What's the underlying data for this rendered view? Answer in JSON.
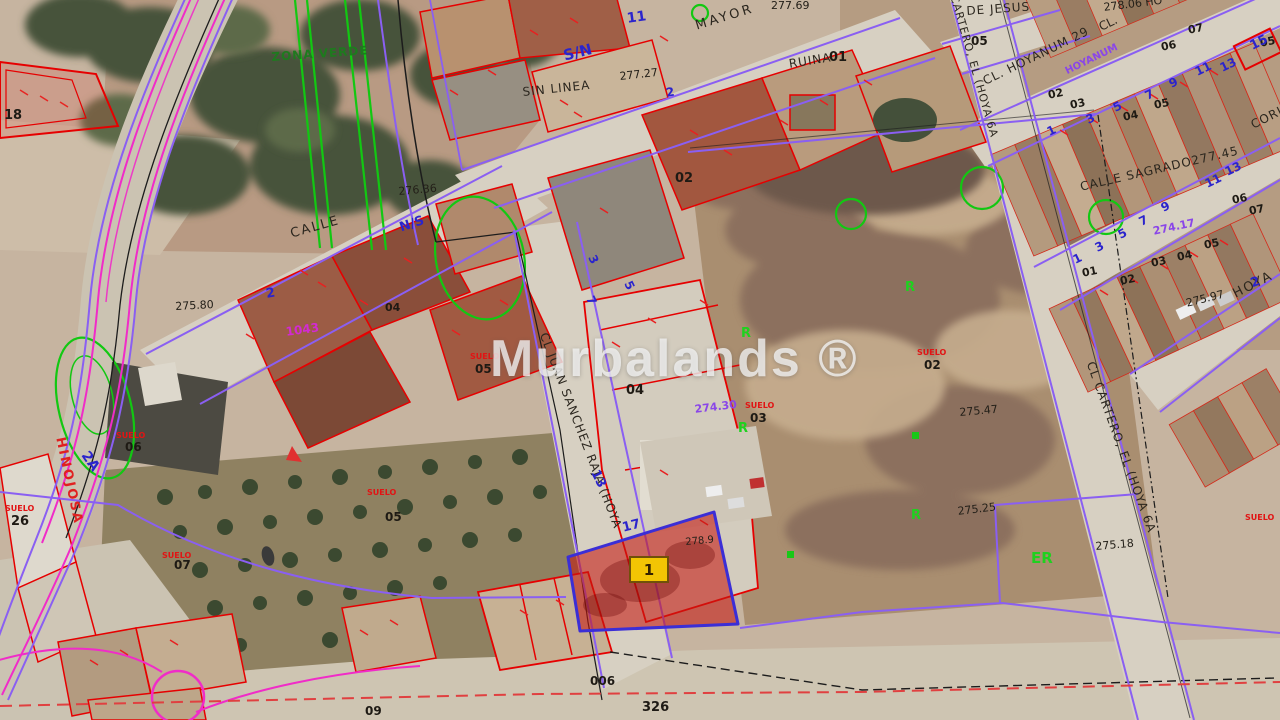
{
  "watermark": {
    "text": "Murbalands ®"
  },
  "parcel_badge": {
    "label": "1"
  },
  "annotations": [
    {
      "id": "mayor",
      "text": "MAYOR",
      "c": "st",
      "x": 694,
      "y": 20,
      "r": -17,
      "s": 13,
      "ls": 3
    },
    {
      "id": "sin-linea",
      "text": "SIN LINEA",
      "c": "st",
      "x": 522,
      "y": 86,
      "r": -6,
      "s": 12,
      "ls": 1
    },
    {
      "id": "calle-west",
      "text": "CALLE",
      "c": "st",
      "x": 289,
      "y": 228,
      "r": -16,
      "s": 13,
      "ls": 2
    },
    {
      "id": "calle-sagrado",
      "text": "CALLE SAGRADO277.45",
      "c": "st",
      "x": 1079,
      "y": 181,
      "r": -13,
      "s": 12,
      "ls": 1
    },
    {
      "id": "hoya",
      "text": "HOYA",
      "c": "st",
      "x": 1231,
      "y": 289,
      "r": -27,
      "s": 13,
      "ls": 2
    },
    {
      "id": "de-jesus",
      "text": "DE JESUS",
      "c": "st",
      "x": 966,
      "y": 5,
      "r": -4,
      "s": 12,
      "ls": 1
    },
    {
      "id": "cl-hoyanum",
      "text": "CL. HOYANUM 29",
      "c": "st",
      "x": 981,
      "y": 76,
      "r": -26,
      "s": 12,
      "ls": 1
    },
    {
      "id": "cl-abbrev",
      "text": "CL.",
      "c": "st",
      "x": 1097,
      "y": 22,
      "r": -26,
      "s": 12
    },
    {
      "id": "juan-sanchez",
      "text": "CL JUAN SANCHEZ RAJA (HOYA",
      "c": "st",
      "x": 549,
      "y": 331,
      "r": 69,
      "s": 12,
      "ls": 1
    },
    {
      "id": "cartero",
      "text": "CL CARTERO, EL (HOYA 6A",
      "c": "st",
      "x": 1096,
      "y": 360,
      "r": 70,
      "s": 12,
      "ls": 1
    },
    {
      "id": "cartero-top",
      "text": "CARTERO, EL (HOYA 6A",
      "c": "st",
      "x": 959,
      "y": -6,
      "r": 74,
      "s": 11,
      "ls": 1
    },
    {
      "id": "cori",
      "text": "CORI",
      "c": "st",
      "x": 1249,
      "y": 120,
      "r": -27,
      "s": 12,
      "ls": 1
    },
    {
      "id": "ruina",
      "text": "RUINA",
      "c": "st",
      "x": 788,
      "y": 58,
      "r": -9,
      "s": 12,
      "ls": 1
    },
    {
      "id": "hinojosa",
      "text": "HINOJOSA",
      "c": "rst",
      "x": 66,
      "y": 436,
      "r": 78,
      "s": 13,
      "ls": 2
    },
    {
      "id": "zona-verde",
      "text": "ZONA VERDE",
      "c": "gst",
      "x": 271,
      "y": 51,
      "r": -4,
      "s": 12,
      "ls": 1
    },
    {
      "id": "e27769",
      "text": "277.69",
      "c": "el",
      "x": 771,
      "y": 0,
      "r": 0,
      "s": 11
    },
    {
      "id": "e27727",
      "text": "277.27",
      "c": "el",
      "x": 619,
      "y": 71,
      "r": -6,
      "s": 11
    },
    {
      "id": "e27636",
      "text": "276.36",
      "c": "el",
      "x": 398,
      "y": 186,
      "r": -5,
      "s": 11
    },
    {
      "id": "e27580",
      "text": "275.80",
      "c": "el",
      "x": 175,
      "y": 301,
      "r": -3,
      "s": 11
    },
    {
      "id": "e27547",
      "text": "275.47",
      "c": "el",
      "x": 959,
      "y": 407,
      "r": -5,
      "s": 11
    },
    {
      "id": "e27525",
      "text": "275.25",
      "c": "el",
      "x": 957,
      "y": 506,
      "r": -7,
      "s": 11
    },
    {
      "id": "e27518",
      "text": "275.18",
      "c": "el",
      "x": 1095,
      "y": 541,
      "r": -5,
      "s": 11
    },
    {
      "id": "e27597",
      "text": "275.97",
      "c": "el",
      "x": 1185,
      "y": 298,
      "r": -14,
      "s": 11
    },
    {
      "id": "e2789",
      "text": "278.9",
      "c": "el",
      "x": 685,
      "y": 538,
      "r": -5,
      "s": 10
    },
    {
      "id": "e27806",
      "text": "278.06 HO",
      "c": "el",
      "x": 1103,
      "y": 2,
      "r": -7,
      "s": 11
    },
    {
      "id": "p27430",
      "text": "274.30",
      "c": "pu",
      "x": 694,
      "y": 404,
      "r": -7,
      "s": 11
    },
    {
      "id": "p27417",
      "text": "274.17",
      "c": "pu",
      "x": 1152,
      "y": 226,
      "r": -12,
      "s": 11
    },
    {
      "id": "p-hoyanum",
      "text": "HOYANUM",
      "c": "pu",
      "x": 1064,
      "y": 68,
      "r": -26,
      "s": 10
    },
    {
      "id": "n18",
      "text": "18",
      "c": "nu",
      "x": 4,
      "y": 109,
      "r": 0,
      "s": 13
    },
    {
      "id": "n26",
      "text": "26",
      "c": "nu",
      "x": 11,
      "y": 515,
      "r": 0,
      "s": 13
    },
    {
      "id": "n01",
      "text": "01",
      "c": "nu",
      "x": 829,
      "y": 51,
      "r": 0,
      "s": 13
    },
    {
      "id": "n02",
      "text": "02",
      "c": "nu",
      "x": 675,
      "y": 172,
      "r": 0,
      "s": 13
    },
    {
      "id": "n04a",
      "text": "04",
      "c": "nu",
      "x": 385,
      "y": 302,
      "r": 0,
      "s": 11
    },
    {
      "id": "n04b",
      "text": "04",
      "c": "nu",
      "x": 626,
      "y": 384,
      "r": 0,
      "s": 13
    },
    {
      "id": "n05a",
      "text": "05",
      "c": "nu",
      "x": 971,
      "y": 35,
      "r": 0,
      "s": 12
    },
    {
      "id": "n06a",
      "text": "06",
      "c": "nu",
      "x": 125,
      "y": 441,
      "r": 0,
      "s": 12
    },
    {
      "id": "n05b",
      "text": "05",
      "c": "nu",
      "x": 475,
      "y": 363,
      "r": 0,
      "s": 12
    },
    {
      "id": "n05c",
      "text": "05",
      "c": "nu",
      "x": 385,
      "y": 511,
      "r": 0,
      "s": 12
    },
    {
      "id": "n07a",
      "text": "07",
      "c": "nu",
      "x": 174,
      "y": 559,
      "r": 0,
      "s": 12
    },
    {
      "id": "n03a",
      "text": "03",
      "c": "nu",
      "x": 750,
      "y": 412,
      "r": 0,
      "s": 12
    },
    {
      "id": "n02b",
      "text": "02",
      "c": "nu",
      "x": 924,
      "y": 359,
      "r": 0,
      "s": 12
    },
    {
      "id": "n006",
      "text": "006",
      "c": "nu",
      "x": 590,
      "y": 675,
      "r": 0,
      "s": 12
    },
    {
      "id": "n326",
      "text": "326",
      "c": "nu",
      "x": 642,
      "y": 701,
      "r": 0,
      "s": 13
    },
    {
      "id": "n09",
      "text": "09",
      "c": "nu",
      "x": 365,
      "y": 705,
      "r": 0,
      "s": 12
    },
    {
      "id": "ra02",
      "text": "02",
      "c": "nu",
      "x": 1047,
      "y": 90,
      "r": -12,
      "s": 11
    },
    {
      "id": "ra03",
      "text": "03",
      "c": "nu",
      "x": 1069,
      "y": 100,
      "r": -12,
      "s": 11
    },
    {
      "id": "ra04",
      "text": "04",
      "c": "nu",
      "x": 1122,
      "y": 112,
      "r": -12,
      "s": 11
    },
    {
      "id": "ra05",
      "text": "05",
      "c": "nu",
      "x": 1153,
      "y": 100,
      "r": -12,
      "s": 11
    },
    {
      "id": "ra06",
      "text": "06",
      "c": "nu",
      "x": 1160,
      "y": 42,
      "r": -12,
      "s": 11
    },
    {
      "id": "ra07",
      "text": "07",
      "c": "nu",
      "x": 1187,
      "y": 25,
      "r": -12,
      "s": 11
    },
    {
      "id": "ra05b",
      "text": "05",
      "c": "nu",
      "x": 1259,
      "y": 38,
      "r": -12,
      "s": 11
    },
    {
      "id": "rb01",
      "text": "01",
      "c": "nu",
      "x": 1081,
      "y": 268,
      "r": -12,
      "s": 11
    },
    {
      "id": "rb02",
      "text": "02",
      "c": "nu",
      "x": 1119,
      "y": 276,
      "r": -12,
      "s": 11
    },
    {
      "id": "rb03",
      "text": "03",
      "c": "nu",
      "x": 1150,
      "y": 258,
      "r": -12,
      "s": 11
    },
    {
      "id": "rb04",
      "text": "04",
      "c": "nu",
      "x": 1176,
      "y": 252,
      "r": -12,
      "s": 11
    },
    {
      "id": "rb05",
      "text": "05",
      "c": "nu",
      "x": 1203,
      "y": 240,
      "r": -12,
      "s": 11
    },
    {
      "id": "rb06",
      "text": "06",
      "c": "nu",
      "x": 1231,
      "y": 195,
      "r": -12,
      "s": 11
    },
    {
      "id": "rb07",
      "text": "07",
      "c": "nu",
      "x": 1248,
      "y": 206,
      "r": -12,
      "s": 11
    },
    {
      "id": "b11",
      "text": "11",
      "c": "bl",
      "x": 626,
      "y": 12,
      "r": -8,
      "s": 14
    },
    {
      "id": "bsn",
      "text": "S/N",
      "c": "bl",
      "x": 562,
      "y": 49,
      "r": -14,
      "s": 15
    },
    {
      "id": "b2a",
      "text": "2",
      "c": "bl",
      "x": 665,
      "y": 87,
      "r": -10,
      "s": 12
    },
    {
      "id": "bns",
      "text": "N/S",
      "c": "bl",
      "x": 398,
      "y": 222,
      "r": -18,
      "s": 13
    },
    {
      "id": "b2b",
      "text": "2",
      "c": "bl",
      "x": 265,
      "y": 288,
      "r": -10,
      "s": 13
    },
    {
      "id": "b2A",
      "text": "2A",
      "c": "bl",
      "x": 90,
      "y": 449,
      "r": 55,
      "s": 14
    },
    {
      "id": "b3",
      "text": "3",
      "c": "bl",
      "x": 597,
      "y": 253,
      "r": 64,
      "s": 12
    },
    {
      "id": "b5",
      "text": "5",
      "c": "bl",
      "x": 633,
      "y": 279,
      "r": 64,
      "s": 12
    },
    {
      "id": "b7",
      "text": "7",
      "c": "bl",
      "x": 595,
      "y": 294,
      "r": 64,
      "s": 12
    },
    {
      "id": "b13",
      "text": "13",
      "c": "bl",
      "x": 600,
      "y": 468,
      "r": 64,
      "s": 13
    },
    {
      "id": "b17",
      "text": "17",
      "c": "bl",
      "x": 621,
      "y": 522,
      "r": -14,
      "s": 13
    },
    {
      "id": "b2c",
      "text": "2",
      "c": "bl",
      "x": 1249,
      "y": 278,
      "r": -20,
      "s": 13
    },
    {
      "id": "ba1",
      "text": "1",
      "c": "bl",
      "x": 1045,
      "y": 127,
      "r": -26,
      "s": 12
    },
    {
      "id": "ba3",
      "text": "3",
      "c": "bl",
      "x": 1084,
      "y": 115,
      "r": -26,
      "s": 12
    },
    {
      "id": "ba5",
      "text": "5",
      "c": "bl",
      "x": 1111,
      "y": 103,
      "r": -26,
      "s": 12
    },
    {
      "id": "ba7",
      "text": "7",
      "c": "bl",
      "x": 1143,
      "y": 91,
      "r": -26,
      "s": 12
    },
    {
      "id": "ba9",
      "text": "9",
      "c": "bl",
      "x": 1167,
      "y": 79,
      "r": -26,
      "s": 12
    },
    {
      "id": "ba11",
      "text": "11",
      "c": "bl",
      "x": 1193,
      "y": 67,
      "r": -26,
      "s": 12
    },
    {
      "id": "ba13",
      "text": "13",
      "c": "bl",
      "x": 1218,
      "y": 63,
      "r": -26,
      "s": 12
    },
    {
      "id": "ba15",
      "text": "15",
      "c": "bl",
      "x": 1248,
      "y": 41,
      "r": -26,
      "s": 13
    },
    {
      "id": "bb1",
      "text": "1",
      "c": "bl",
      "x": 1071,
      "y": 255,
      "r": -26,
      "s": 12
    },
    {
      "id": "bb3",
      "text": "3",
      "c": "bl",
      "x": 1093,
      "y": 243,
      "r": -26,
      "s": 12
    },
    {
      "id": "bb5",
      "text": "5",
      "c": "bl",
      "x": 1116,
      "y": 230,
      "r": -26,
      "s": 12
    },
    {
      "id": "bb7",
      "text": "7",
      "c": "bl",
      "x": 1137,
      "y": 217,
      "r": -26,
      "s": 12
    },
    {
      "id": "bb9",
      "text": "9",
      "c": "bl",
      "x": 1159,
      "y": 203,
      "r": -26,
      "s": 12
    },
    {
      "id": "bb11",
      "text": "11",
      "c": "bl",
      "x": 1203,
      "y": 179,
      "r": -26,
      "s": 12
    },
    {
      "id": "bb13",
      "text": "13",
      "c": "bl",
      "x": 1223,
      "y": 167,
      "r": -26,
      "s": 12
    },
    {
      "id": "m1043",
      "text": "1043",
      "c": "mg",
      "x": 285,
      "y": 326,
      "r": -8,
      "s": 12
    },
    {
      "id": "su1",
      "text": "SUELO",
      "c": "rd",
      "x": 116,
      "y": 432,
      "r": 0,
      "s": 8
    },
    {
      "id": "su2",
      "text": "SUELO",
      "c": "rd",
      "x": 470,
      "y": 353,
      "r": 0,
      "s": 8
    },
    {
      "id": "su3",
      "text": "SUELO",
      "c": "rd",
      "x": 367,
      "y": 489,
      "r": 0,
      "s": 8
    },
    {
      "id": "su4",
      "text": "SUELO",
      "c": "rd",
      "x": 162,
      "y": 552,
      "r": 0,
      "s": 8
    },
    {
      "id": "su5",
      "text": "SUELO",
      "c": "rd",
      "x": 745,
      "y": 402,
      "r": 0,
      "s": 8
    },
    {
      "id": "su6",
      "text": "SUELO",
      "c": "rd",
      "x": 917,
      "y": 349,
      "r": 0,
      "s": 8
    },
    {
      "id": "su7",
      "text": "SUELO",
      "c": "rd",
      "x": 1245,
      "y": 514,
      "r": 0,
      "s": 8
    },
    {
      "id": "su8",
      "text": "SUELO",
      "c": "rd",
      "x": 5,
      "y": 505,
      "r": 0,
      "s": 8
    },
    {
      "id": "gr1",
      "text": "R",
      "c": "gr",
      "x": 741,
      "y": 327,
      "r": 0,
      "s": 13
    },
    {
      "id": "gr2",
      "text": "R",
      "c": "gr",
      "x": 738,
      "y": 422,
      "r": 0,
      "s": 13
    },
    {
      "id": "gr3",
      "text": "R",
      "c": "gr",
      "x": 905,
      "y": 281,
      "r": 0,
      "s": 13
    },
    {
      "id": "gr4",
      "text": "R",
      "c": "gr",
      "x": 911,
      "y": 509,
      "r": 0,
      "s": 13
    },
    {
      "id": "ger",
      "text": "ER",
      "c": "gr",
      "x": 1031,
      "y": 551,
      "r": 0,
      "s": 15
    }
  ]
}
